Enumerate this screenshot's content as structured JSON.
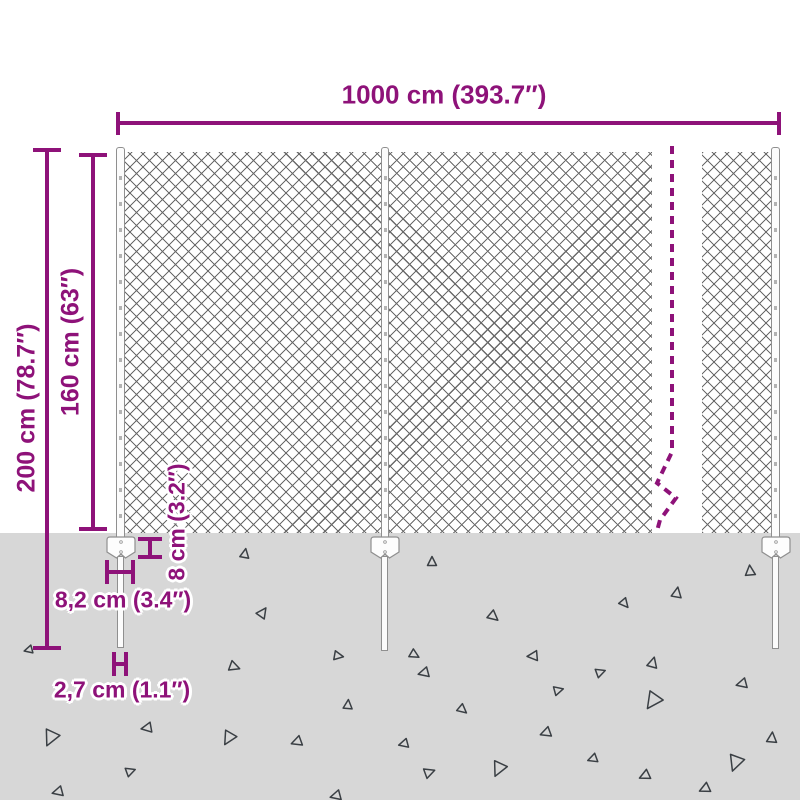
{
  "title": "Chain-link fence dimension diagram",
  "colors": {
    "accent": "#8e1279",
    "ground": "#d7d7d7",
    "mesh_line": "#4a4a4a",
    "post_outline": "#8f8f8f",
    "triangle": "#3a3f44"
  },
  "dimensions": {
    "width": {
      "label": "1000 cm (393.7″)"
    },
    "total_height": {
      "label": "200 cm (78.7″)"
    },
    "fence_height": {
      "label": "160 cm (63″)"
    },
    "anchor_depth": {
      "label": "8 cm (3.2″)"
    },
    "anchor_width": {
      "label": "8,2 cm (3.4″)"
    },
    "stake_width": {
      "label": "2,7 cm (1.1″)"
    }
  },
  "ground": {
    "triangles": [
      [
        245,
        553,
        9,
        10
      ],
      [
        432,
        561,
        9,
        0
      ],
      [
        750,
        570,
        10,
        355
      ],
      [
        263,
        612,
        10,
        35
      ],
      [
        677,
        592,
        10,
        10
      ],
      [
        625,
        604,
        9,
        140
      ],
      [
        494,
        617,
        10,
        130
      ],
      [
        348,
        704,
        9,
        5
      ],
      [
        339,
        656,
        9,
        100
      ],
      [
        235,
        667,
        10,
        110
      ],
      [
        415,
        655,
        9,
        120
      ],
      [
        423,
        673,
        10,
        255
      ],
      [
        532,
        656,
        10,
        265
      ],
      [
        653,
        662,
        10,
        15
      ],
      [
        601,
        672,
        9,
        70
      ],
      [
        741,
        684,
        10,
        255
      ],
      [
        463,
        710,
        9,
        130
      ],
      [
        652,
        702,
        16,
        215
      ],
      [
        559,
        690,
        9,
        75
      ],
      [
        545,
        733,
        10,
        250
      ],
      [
        403,
        744,
        9,
        255
      ],
      [
        772,
        737,
        10,
        5
      ],
      [
        50,
        739,
        15,
        205
      ],
      [
        146,
        728,
        10,
        260
      ],
      [
        228,
        739,
        13,
        210
      ],
      [
        296,
        742,
        10,
        250
      ],
      [
        131,
        771,
        9,
        70
      ],
      [
        57,
        792,
        10,
        255
      ],
      [
        335,
        796,
        10,
        255
      ],
      [
        592,
        759,
        9,
        250
      ],
      [
        430,
        772,
        10,
        70
      ],
      [
        498,
        770,
        14,
        205
      ],
      [
        644,
        776,
        10,
        245
      ],
      [
        735,
        764,
        15,
        200
      ],
      [
        704,
        789,
        10,
        245
      ],
      [
        28,
        650,
        8,
        255
      ]
    ]
  }
}
